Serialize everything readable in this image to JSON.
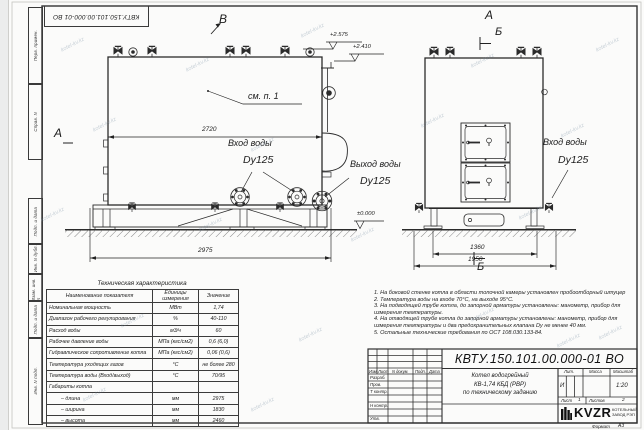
{
  "watermark": {
    "text": "kotel-kv.kz"
  },
  "stamp_top": "КВТУ.150.101.00.000-01 ВО",
  "frame_side_labels": [
    "Перв. примен.",
    "Справ. N",
    "Подп. и дата",
    "Инв. N дубл.",
    "Взам. инв. N",
    "Подп. и дата",
    "Инв. N подл."
  ],
  "labels": {
    "view_v": "В",
    "view_a_left": "А",
    "view_a_right": "А",
    "view_b_top": "Б",
    "view_b_bottom": "Б",
    "see_note": "см. п. 1",
    "water_inlet": "Вход воды",
    "water_inlet_dn": "Dy125",
    "water_outlet": "Выход воды",
    "water_outlet_dn": "Dy125",
    "water_inlet2": "Вход воды",
    "water_inlet2_dn": "Dy125"
  },
  "dimensions": {
    "body_length": "2720",
    "total_length": "2975",
    "base_width": "1360",
    "total_width": "1950",
    "elev_valves": "+2.575",
    "elev_flue": "+2.410",
    "elev_zero": "±0.000"
  },
  "spec_table": {
    "title": "Техническая характеристика",
    "headers": [
      "Наименование показателя",
      "Единицы измерения",
      "Значение"
    ],
    "rows": [
      [
        "Номинальная мощность",
        "МВт",
        "1,74"
      ],
      [
        "Диапазон рабочего регулирования",
        "%",
        "40-110"
      ],
      [
        "Расход воды",
        "м3/ч",
        "60"
      ],
      [
        "Рабочее давление воды",
        "МПа (кгс/см2)",
        "0,6 (6,0)"
      ],
      [
        "Гидравлическое сопротивление котла",
        "МПа (кгс/см2)",
        "0,06 (0,6)"
      ],
      [
        "Температура уходящих газов",
        "°С",
        "не более 280"
      ],
      [
        "Температура воды (Вход/выход)",
        "°С",
        "70/95"
      ],
      [
        "Габариты котла",
        "",
        ""
      ],
      [
        "– длина",
        "мм",
        "2975"
      ],
      [
        "– ширина",
        "мм",
        "1830"
      ],
      [
        "– высота",
        "мм",
        "2460"
      ]
    ]
  },
  "notes": [
    "1. На боковой стенке котла в области топочной камеры установлен пробоотборный штуцер",
    "2. Температура воды на входе 70°С, на выходе 95°С.",
    "3. На подводящей трубе котла, до запорной арматуры установлены: манометр, прибор для",
    "измерения температуры.",
    "4. На отводящей трубе котла до запорной арматуры установлены: манометр, прибор для",
    "измерения температуры и два предохранительных клапана Dу не менее 40 мм.",
    "5. Остальные технические требования по ОСТ 108.030.133-84."
  ],
  "title_block": {
    "doc_number": "КВТУ.150.101.00.000-01 ВО",
    "change_cols": [
      "Изм.",
      "Лист",
      "N докум.",
      "Подп.",
      "Дата"
    ],
    "sign_rows": [
      "Разраб.",
      "Пров.",
      "Т контр.",
      "Н контр.",
      "Утв."
    ],
    "product_name_lines": [
      "Котел водогрейный",
      "КВ-1,74 КБД (РВР)",
      "по техническому заданию"
    ],
    "lit_label": "Лит.",
    "mass_label": "Масса",
    "scale_label": "Масштаб",
    "lit_value": "И",
    "scale_value": "1:20",
    "sheet_label": "Лист",
    "sheet_value": "1",
    "sheets_label": "Листов",
    "sheets_value": "2",
    "logo_text": "KVZR",
    "logo_sub_line1": "КОТЕЛЬНЫЙ",
    "logo_sub_line2": "ЗАВОД РЭП",
    "format_label": "Формат",
    "format_value": "А3"
  }
}
